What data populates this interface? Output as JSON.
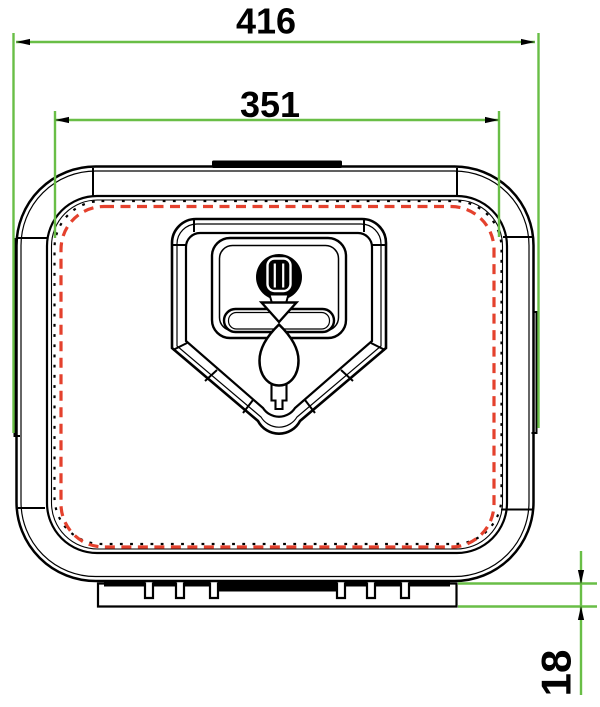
{
  "drawing": {
    "type": "technical-dimension-drawing",
    "dimensions": {
      "overall_width": {
        "value": "416",
        "orientation": "horizontal"
      },
      "inner_width": {
        "value": "351",
        "orientation": "horizontal"
      },
      "flange_height": {
        "value": "18",
        "orientation": "vertical"
      }
    },
    "colors": {
      "dimension_lines": "#69be46",
      "seal_line": "#e4412d",
      "outline": "#000000",
      "background": "#ffffff"
    }
  }
}
